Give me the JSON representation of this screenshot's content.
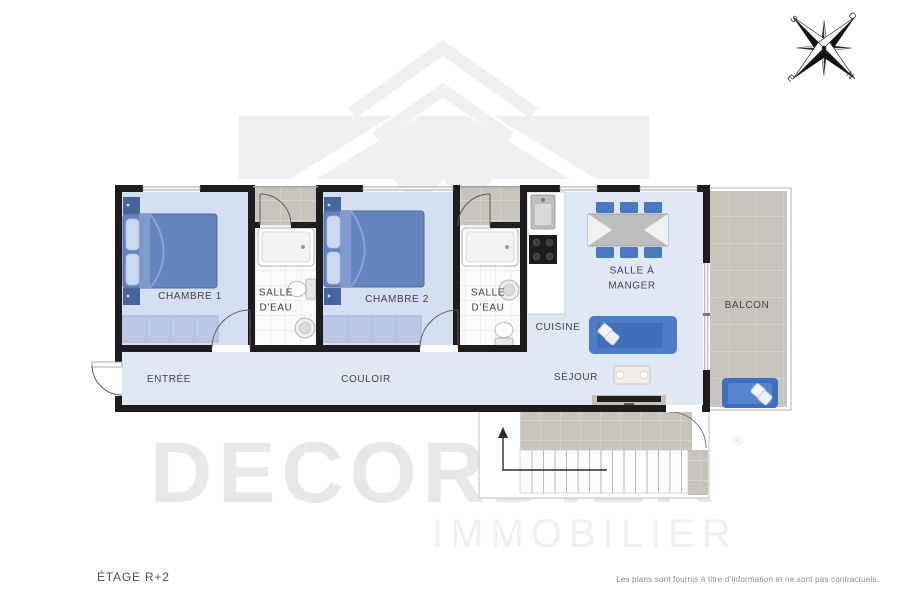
{
  "branding": {
    "wordmark": "DECORDIER",
    "registered_mark": "®",
    "subtitle": "IMMOBILIER"
  },
  "compass": {
    "north": "N",
    "south": "S",
    "east": "E",
    "west": "O"
  },
  "rooms": {
    "chambre1": "CHAMBRE 1",
    "salle_eau_1": "SALLE\nD’EAU",
    "chambre2": "CHAMBRE 2",
    "salle_eau_2": "SALLE\nD’EAU",
    "cuisine": "CUISINE",
    "salle_a_manger": "SALLE À\nMANGER",
    "balcon": "BALCON",
    "entree": "ENTRÉE",
    "couloir": "COULOIR",
    "sejour": "SÉJOUR"
  },
  "footer": {
    "floor_label": "ÉTAGE R+2",
    "disclaimer": "Les plans sont fournis à titre d’information et ne sont pas contractuels."
  },
  "colors": {
    "wall": "#1d1d1f",
    "floor_blue": "#dfe8f7",
    "room_blue": "#d4dff2",
    "furniture_blue": "#4a79c4",
    "tile_gray": "#c8c4bb",
    "watermark_gray": "#f0f0f0"
  }
}
